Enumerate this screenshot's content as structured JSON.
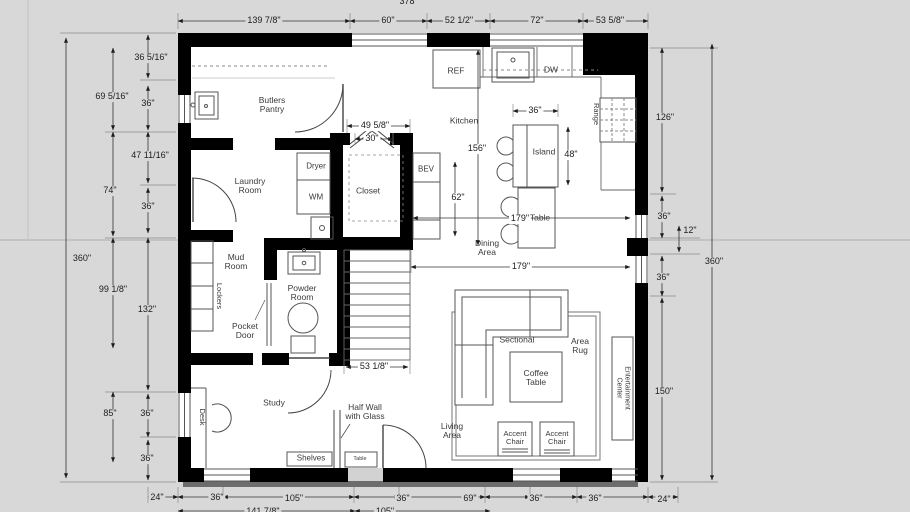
{
  "app": {
    "background_color": "#d8d8d8",
    "wall_color": "#000000",
    "line_color": "#444444"
  },
  "labels": [
    {
      "n": "dim-top-139",
      "t": "139 7/8\"",
      "x": 264,
      "y": 21,
      "c": "de"
    },
    {
      "n": "dim-top-60",
      "t": "60\"",
      "x": 388,
      "y": 21,
      "c": "de"
    },
    {
      "n": "dim-top-52",
      "t": "52 1/2\"",
      "x": 459,
      "y": 21,
      "c": "de"
    },
    {
      "n": "dim-top-72",
      "t": "72\"",
      "x": 537,
      "y": 21,
      "c": "de"
    },
    {
      "n": "dim-top-53",
      "t": "53 5/8\"",
      "x": 610,
      "y": 21,
      "c": "de"
    },
    {
      "n": "dim-top-378",
      "t": "378",
      "x": 407,
      "y": 2,
      "c": "de"
    },
    {
      "n": "dim-left-360",
      "t": "360\"",
      "x": 82,
      "y": 259,
      "c": "de"
    },
    {
      "n": "dim-left-69",
      "t": "69 5/16\"",
      "x": 112,
      "y": 97,
      "c": "de"
    },
    {
      "n": "dim-left-74",
      "t": "74\"",
      "x": 110,
      "y": 191,
      "c": "de"
    },
    {
      "n": "dim-left-99",
      "t": "99 1/8\"",
      "x": 113,
      "y": 290,
      "c": "de"
    },
    {
      "n": "dim-left-85",
      "t": "85\"",
      "x": 110,
      "y": 414,
      "c": "de"
    },
    {
      "n": "dim-left-36a",
      "t": "36 5/16\"",
      "x": 151,
      "y": 58,
      "c": "de"
    },
    {
      "n": "dim-left-36b",
      "t": "36\"",
      "x": 148,
      "y": 104,
      "c": "de"
    },
    {
      "n": "dim-left-47",
      "t": "47 11/16\"",
      "x": 150,
      "y": 156,
      "c": "de"
    },
    {
      "n": "dim-left-36c",
      "t": "36\"",
      "x": 148,
      "y": 207,
      "c": "de"
    },
    {
      "n": "dim-left-132",
      "t": "132\"",
      "x": 147,
      "y": 310,
      "c": "de"
    },
    {
      "n": "dim-left-36d",
      "t": "36\"",
      "x": 147,
      "y": 414,
      "c": "de"
    },
    {
      "n": "dim-left-36e",
      "t": "36\"",
      "x": 147,
      "y": 459,
      "c": "de"
    },
    {
      "n": "dim-right-126",
      "t": "126\"",
      "x": 665,
      "y": 118,
      "c": "de"
    },
    {
      "n": "dim-right-36a",
      "t": "36\"",
      "x": 664,
      "y": 217,
      "c": "de"
    },
    {
      "n": "dim-right-12",
      "t": "12\"",
      "x": 690,
      "y": 231,
      "c": "de"
    },
    {
      "n": "dim-right-360",
      "t": "360\"",
      "x": 714,
      "y": 262,
      "c": "de"
    },
    {
      "n": "dim-right-36b",
      "t": "36\"",
      "x": 663,
      "y": 278,
      "c": "de"
    },
    {
      "n": "dim-right-150",
      "t": "150\"",
      "x": 664,
      "y": 392,
      "c": "de"
    },
    {
      "n": "dim-bot-24a",
      "t": "24\"",
      "x": 157,
      "y": 498,
      "c": "de"
    },
    {
      "n": "dim-bot-36a",
      "t": "36\"",
      "x": 217,
      "y": 498,
      "c": "de"
    },
    {
      "n": "dim-bot-105",
      "t": "105\"",
      "x": 294,
      "y": 499,
      "c": "de"
    },
    {
      "n": "dim-bot-36b",
      "t": "36\"",
      "x": 403,
      "y": 499,
      "c": "de"
    },
    {
      "n": "dim-bot-69",
      "t": "69\"",
      "x": 470,
      "y": 499,
      "c": "de"
    },
    {
      "n": "dim-bot-36c",
      "t": "36\"",
      "x": 536,
      "y": 499,
      "c": "de"
    },
    {
      "n": "dim-bot-36d",
      "t": "36\"",
      "x": 595,
      "y": 499,
      "c": "de"
    },
    {
      "n": "dim-bot-24b",
      "t": "24\"",
      "x": 664,
      "y": 500,
      "c": "de"
    },
    {
      "n": "dim-bot2-141",
      "t": "141 7/8\"",
      "x": 263,
      "y": 512,
      "c": "de"
    },
    {
      "n": "dim-bot2-105",
      "t": "105\"",
      "x": 385,
      "y": 512,
      "c": "de"
    },
    {
      "n": "dim-closet-49",
      "t": "49 5/8\"",
      "x": 375,
      "y": 126,
      "c": "di"
    },
    {
      "n": "dim-closet-30",
      "t": "30\"",
      "x": 372,
      "y": 139,
      "c": "di"
    },
    {
      "n": "dim-kitchen-156",
      "t": "156\"",
      "x": 477,
      "y": 149,
      "c": "di"
    },
    {
      "n": "dim-bev-62",
      "t": "62\"",
      "x": 458,
      "y": 198,
      "c": "di"
    },
    {
      "n": "dim-island-36",
      "t": "36\"",
      "x": 535,
      "y": 111,
      "c": "di"
    },
    {
      "n": "dim-island-48",
      "t": "48\"",
      "x": 571,
      "y": 155,
      "c": "di"
    },
    {
      "n": "dim-dining-179a",
      "t": "179\"",
      "x": 520,
      "y": 219,
      "c": "di"
    },
    {
      "n": "dim-living-179b",
      "t": "179\"",
      "x": 521,
      "y": 267,
      "c": "di"
    },
    {
      "n": "dim-stairs-53",
      "t": "53 1/8\"",
      "x": 374,
      "y": 367,
      "c": "di"
    },
    {
      "n": "room-butlers-pantry",
      "t": "Butlers\nPantry",
      "x": 272,
      "y": 105,
      "c": "rm"
    },
    {
      "n": "room-kitchen",
      "t": "Kitchen",
      "x": 464,
      "y": 121,
      "c": "rm"
    },
    {
      "n": "label-ref",
      "t": "REF",
      "x": 456,
      "y": 71,
      "c": "rm"
    },
    {
      "n": "label-dw",
      "t": "DW",
      "x": 551,
      "y": 70,
      "c": "rm"
    },
    {
      "n": "label-range",
      "t": "Range",
      "x": 596,
      "y": 114,
      "r": 90,
      "c": "rm",
      "s": 7.5
    },
    {
      "n": "label-island",
      "t": "Island",
      "x": 544,
      "y": 152,
      "c": "rm"
    },
    {
      "n": "room-closet",
      "t": "Closet",
      "x": 368,
      "y": 191,
      "c": "rm"
    },
    {
      "n": "label-bev",
      "t": "BEV",
      "x": 426,
      "y": 170,
      "c": "rm",
      "s": 8
    },
    {
      "n": "label-dryer",
      "t": "Dryer",
      "x": 316,
      "y": 167,
      "c": "rm",
      "s": 8
    },
    {
      "n": "label-wm",
      "t": "WM",
      "x": 316,
      "y": 198,
      "c": "rm",
      "s": 8
    },
    {
      "n": "room-laundry",
      "t": "Laundry\nRoom",
      "x": 250,
      "y": 186,
      "c": "rm"
    },
    {
      "n": "room-mud",
      "t": "Mud\nRoom",
      "x": 236,
      "y": 262,
      "c": "rm"
    },
    {
      "n": "label-lockers",
      "t": "Lockers",
      "x": 219,
      "y": 296,
      "r": 90,
      "c": "rm",
      "s": 7.5
    },
    {
      "n": "label-pocket-door",
      "t": "Pocket\nDoor",
      "x": 245,
      "y": 331,
      "c": "rm"
    },
    {
      "n": "room-powder",
      "t": "Powder\nRoom",
      "x": 302,
      "y": 293,
      "c": "rm"
    },
    {
      "n": "room-study",
      "t": "Study",
      "x": 274,
      "y": 403,
      "c": "rm"
    },
    {
      "n": "label-desk",
      "t": "Desk",
      "x": 202,
      "y": 417,
      "r": 90,
      "c": "rm",
      "s": 7.5
    },
    {
      "n": "label-half-wall",
      "t": "Half Wall\nwith Glass",
      "x": 365,
      "y": 412,
      "c": "rm"
    },
    {
      "n": "label-shelves",
      "t": "Shelves",
      "x": 311,
      "y": 459,
      "c": "rm",
      "s": 8
    },
    {
      "n": "label-small-table",
      "t": "Table",
      "x": 360,
      "y": 460,
      "c": "rm",
      "s": 5.5
    },
    {
      "n": "room-living",
      "t": "Living\nArea",
      "x": 452,
      "y": 431,
      "c": "rm"
    },
    {
      "n": "label-sectional",
      "t": "Sectional",
      "x": 517,
      "y": 340,
      "c": "rm"
    },
    {
      "n": "label-coffee-table",
      "t": "Coffee\nTable",
      "x": 536,
      "y": 378,
      "c": "rm"
    },
    {
      "n": "label-area-rug",
      "t": "Area\nRug",
      "x": 580,
      "y": 346,
      "c": "rm"
    },
    {
      "n": "label-accent-chair-1",
      "t": "Accent\nChair",
      "x": 515,
      "y": 438,
      "c": "rm",
      "s": 7.5
    },
    {
      "n": "label-accent-chair-2",
      "t": "Accent\nChair",
      "x": 557,
      "y": 438,
      "c": "rm",
      "s": 7.5
    },
    {
      "n": "label-entertainment",
      "t": "Entertainment\nCenter",
      "x": 623,
      "y": 388,
      "r": 90,
      "c": "rm",
      "s": 7
    },
    {
      "n": "room-dining",
      "t": "Dining\nArea",
      "x": 487,
      "y": 248,
      "c": "rm"
    },
    {
      "n": "label-dining-table",
      "t": "Table",
      "x": 540,
      "y": 218,
      "c": "rm"
    }
  ]
}
